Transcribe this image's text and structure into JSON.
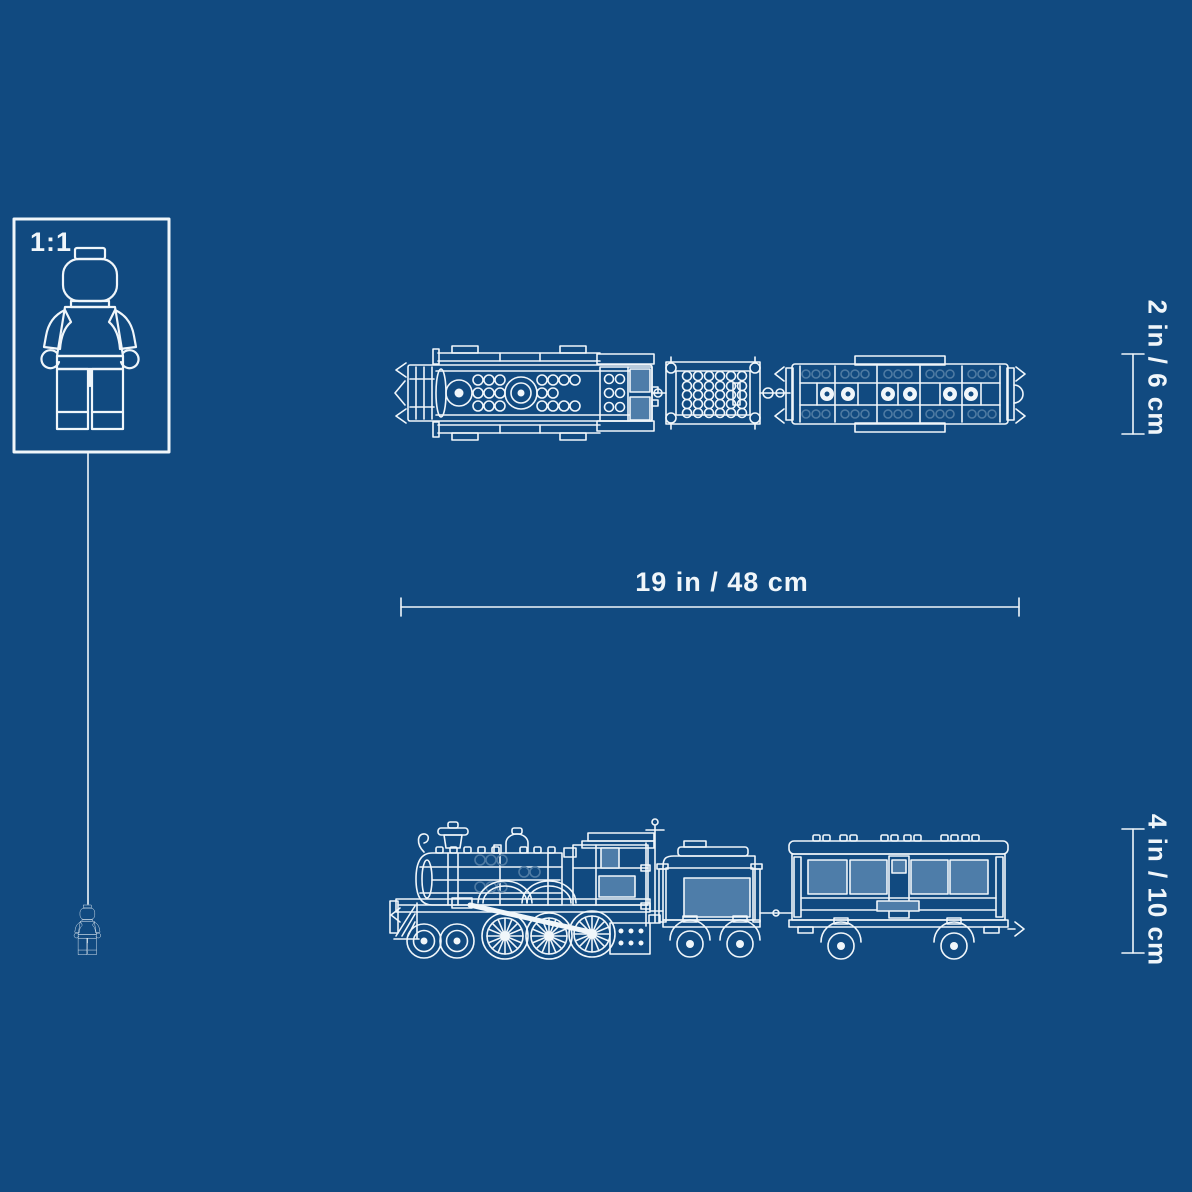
{
  "colors": {
    "background": "#114a80",
    "line": "#f0f6fa",
    "panel": "#4e7da9",
    "ghost": "#4f7ba3"
  },
  "scale_box": {
    "label": "1:1",
    "icon": "minifigure-icon"
  },
  "dimension_labels": {
    "length": "19 in / 48 cm",
    "top_view_height": "2 in / 6 cm",
    "side_view_height": "4 in / 10 cm"
  },
  "figures": {
    "top_view": "train-top-view-blueprint",
    "side_view": "train-side-view-blueprint",
    "train_parts": [
      "locomotive",
      "tender",
      "passenger-car"
    ],
    "scale_reference": "minifigure-icon"
  }
}
